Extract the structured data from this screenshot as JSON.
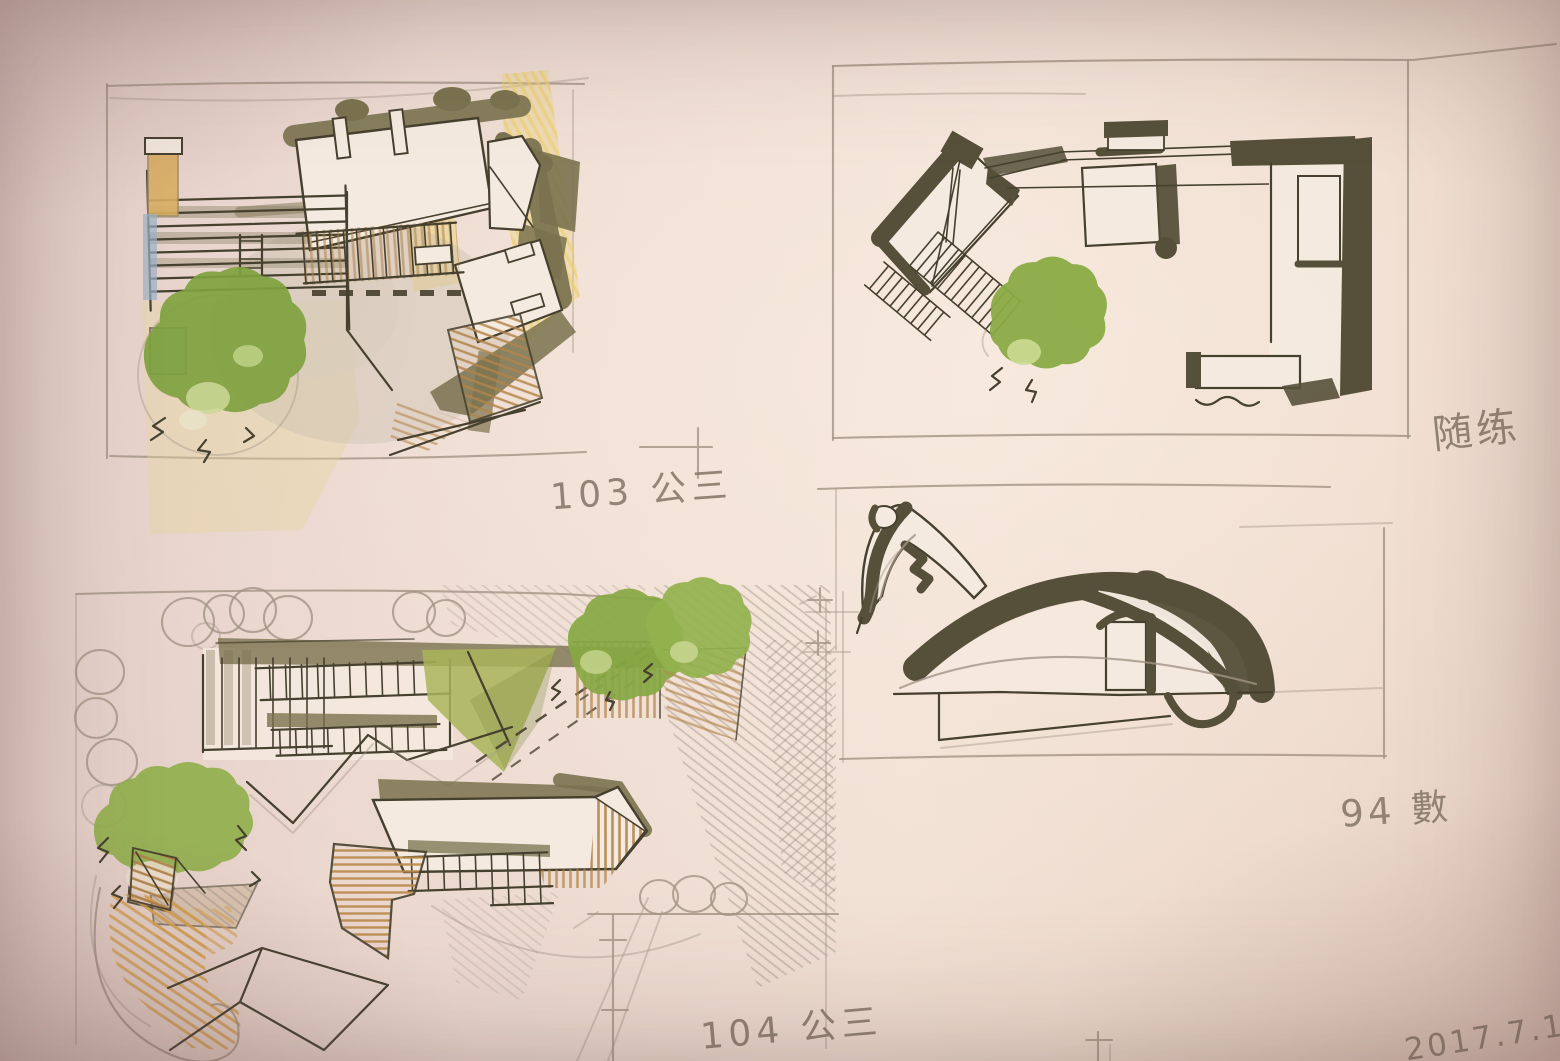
{
  "annotations": {
    "sketch_103": "103 公三",
    "sketch_practice": "随练",
    "sketch_94": "94 數",
    "sketch_104": "104 公三",
    "date": "2017.7.1"
  },
  "palette": {
    "paper": "#f1e0d4",
    "ink": "#46402e",
    "marker_dark": "#56503a",
    "marker_olive": "#7a724f",
    "marker_green": "#8aab45",
    "pencil": "#a29385",
    "wood_tan": "#b3854a",
    "orange_pencil": "#d7a24f",
    "yellow_pencil": "#ecd06e",
    "blue_pencil": "#9cb0c4"
  }
}
